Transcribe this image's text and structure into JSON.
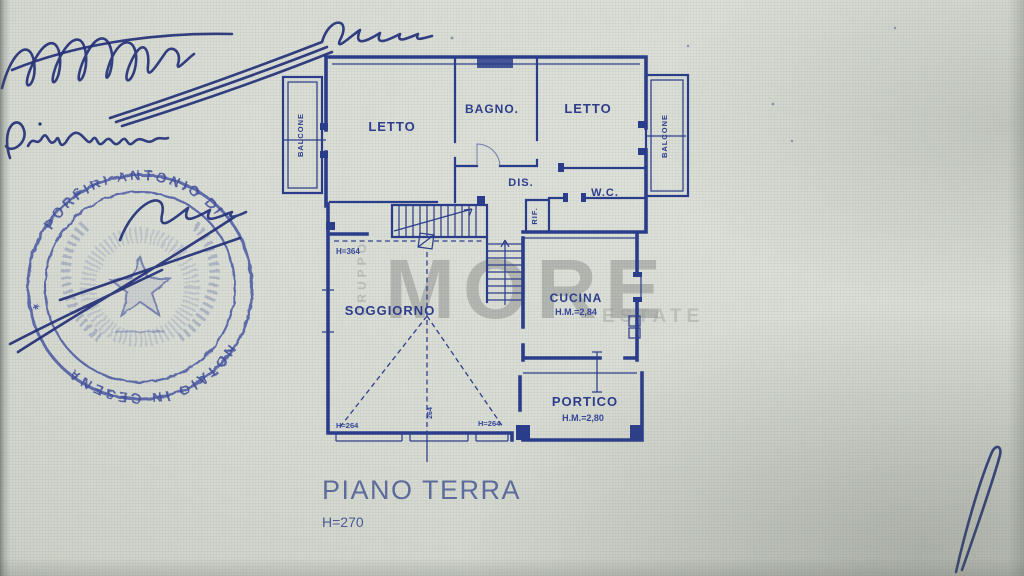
{
  "document": {
    "floor_label": "PIANO TERRA",
    "floor_height": "H=270"
  },
  "plan": {
    "rooms": {
      "letto_left": "LETTO",
      "bagno": "BAGNO.",
      "letto_right": "LETTO",
      "dis": "DIS.",
      "wc": "W.C.",
      "rif": "RIF.",
      "soggiorno": "SOGGIORNO",
      "cucina": "CUCINA",
      "portico": "PORTICO",
      "balcone_left": "BALCONE",
      "balcone_right": "BALCONE"
    },
    "dimensions": {
      "cucina_height": "H.M.=2,84",
      "portico_height": "H.M.=2,80",
      "soggiorno_height": "H=364",
      "wall_left": "H=264",
      "wall_right": "H=264",
      "wall_center": "264"
    }
  },
  "watermark": {
    "group": "GRUPPO",
    "brand": "MORE",
    "suffix": "ESTATE"
  },
  "stamp": {
    "arc_top": "PORFIRI ANTONIO DI",
    "arc_bottom": "NOTAIO IN CESENA",
    "separator": "✶"
  },
  "colors": {
    "ink_blue": "#2c3c8c",
    "stamp_blue": "#3f4e9c",
    "watermark_gray": "#8e908e",
    "paper": "#d7dbd2",
    "title_text": "#5e6d9e"
  }
}
